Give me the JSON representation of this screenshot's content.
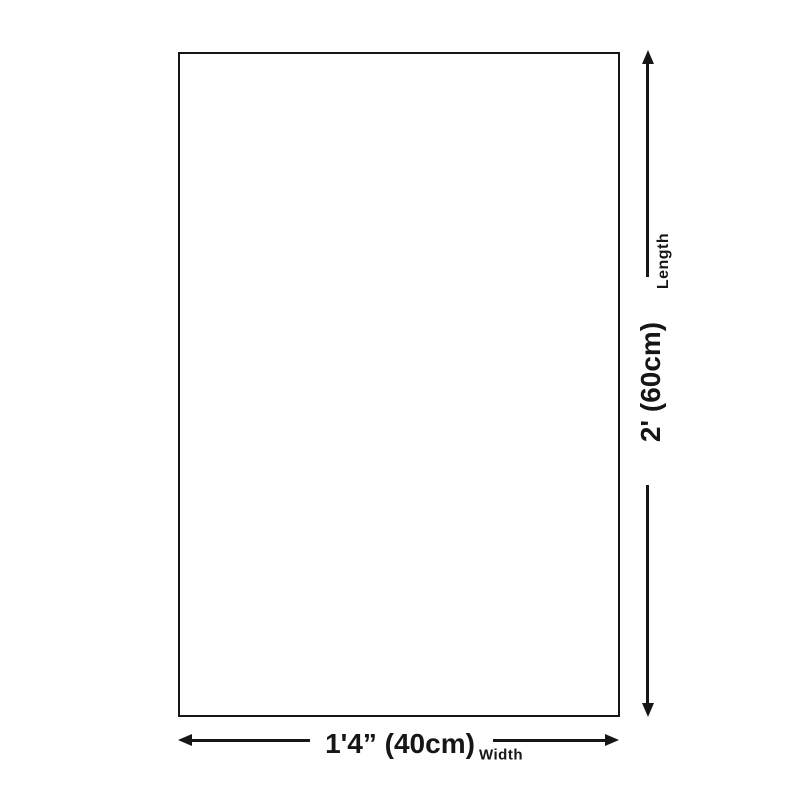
{
  "colors": {
    "line": "#161616",
    "background": "#ffffff"
  },
  "diagram": {
    "type": "product-size-diagram",
    "dimensions": {
      "length": {
        "label": "Length",
        "value": "2' (60cm)",
        "value_cm": 60,
        "orientation": "vertical"
      },
      "width": {
        "label": "Width",
        "value": "1'4” (40cm)",
        "value_cm": 40,
        "orientation": "horizontal"
      }
    }
  }
}
